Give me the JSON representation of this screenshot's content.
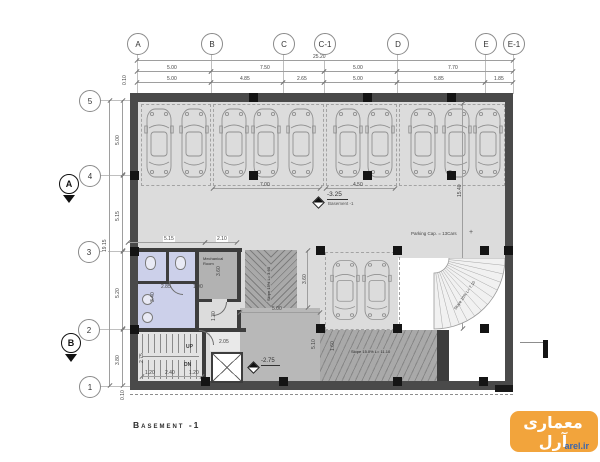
{
  "plan": {
    "title_block": "Basement -1",
    "grid": {
      "columns": [
        "A",
        "B",
        "C",
        "C-1",
        "D",
        "E",
        "E-1"
      ],
      "rows": [
        "5",
        "4",
        "3",
        "2",
        "1"
      ],
      "section_markers": [
        "A",
        "B"
      ]
    },
    "dimensions": {
      "top_total": "25.20",
      "top_row1": [
        "5.00",
        "7.50",
        "5.00",
        "7.70"
      ],
      "top_row2": [
        "5.00",
        "4.85",
        "2.65",
        "5.00",
        "5.85",
        "1.85"
      ],
      "left_total": "19.15",
      "left_segments": [
        "5.00",
        "5.15",
        "5.20",
        "3.80"
      ],
      "parking_bays": [
        "7.00",
        "4.50"
      ],
      "interior": {
        "rooms_top": [
          "5.15",
          "2.10"
        ],
        "wc": [
          "2.85",
          "1.90",
          "3.40",
          "3.60",
          "1.30"
        ],
        "core": [
          "2.05",
          "2.75",
          "1.20",
          "2.40",
          "1.20"
        ],
        "ramp_area": [
          "3.60",
          "5.00",
          "5.10",
          "1.60"
        ],
        "right": [
          "15.40"
        ],
        "wall": [
          "0.10",
          "0.10"
        ]
      }
    },
    "levels": {
      "main": {
        "value": "-3.25",
        "name": "Basement -1"
      },
      "landing": {
        "value": "-2.75"
      }
    },
    "notes": {
      "parking_capacity": "Parking Cap. = 13Cars"
    },
    "ramps": {
      "straight": "Slope 15.0% L= 11.10",
      "entry": "Slope 15% L= 3.60",
      "curved": "Slope 10% L= 7.10"
    },
    "stairs": {
      "up": "UP",
      "down": "DN"
    },
    "rooms": {
      "mechanical_line1": "Mechanical",
      "mechanical_line2": "Room"
    },
    "colors": {
      "floor": "#DCDCDC",
      "wall": "#4A4A4A",
      "wc_room": "#CCD0EA",
      "ramp": "#A9A9A9",
      "watermark_orange": "#F2A43C",
      "watermark_blue": "#3D66AC"
    }
  },
  "watermark": {
    "brand": "معماری آرل",
    "site": "arel.ir"
  }
}
